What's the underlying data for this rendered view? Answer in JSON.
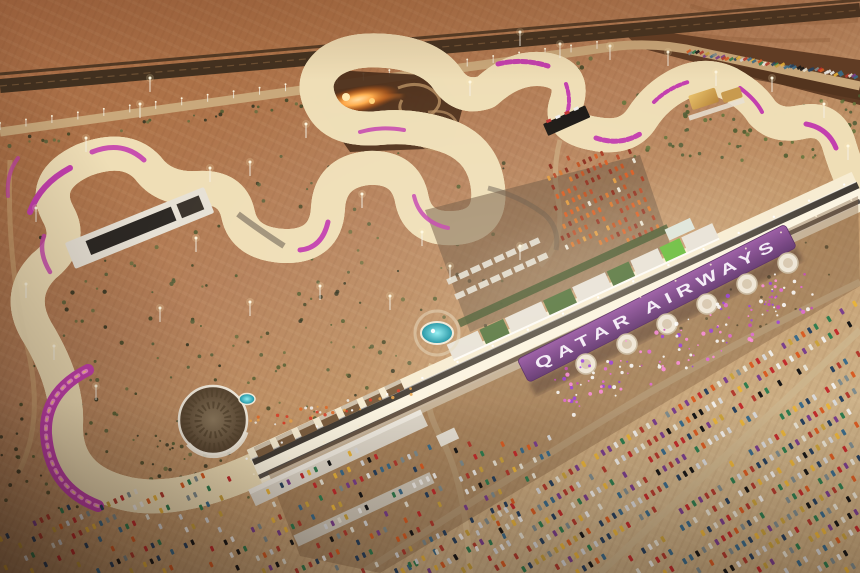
{
  "scene": {
    "type": "aerial-photo-render",
    "time_of_day": "dusk, floodlit",
    "subject": "desert grand prix circuit with illuminated winding track, pit complex, branded grandstand and full car parks",
    "visible_text": {
      "grandstand_roof": "QATAR AIRWAYS"
    },
    "palette": {
      "desert_top": "#a36843",
      "desert_mid": "#b5805a",
      "desert_light": "#d3b285",
      "runoff_sand": "#eeddb6",
      "lit_tarmac": "#f7ecd2",
      "track_asphalt": "#3a342e",
      "roof_purple": "#7b4488",
      "roof_text": "#f3ebf6",
      "kerb_magenta": "#c33fae",
      "kerb_pink": "#ff9bd9",
      "accent_gold": "#ffd27a",
      "pool_teal": "#2fc6cf",
      "pit_green": "#5e7c48",
      "bright_green": "#6fbf44",
      "fire_orange": "#ff8c2e",
      "shadow_brown": "#24140b"
    }
  },
  "parking": {
    "car_palette": [
      "#d8d8d8",
      "#f0ede8",
      "#b23b2e",
      "#d85c23",
      "#e8b33a",
      "#27415e",
      "#7f8c8d",
      "#2f7d4f",
      "#7a3f8c",
      "#171717",
      "#c22c2c",
      "#e8e2d2",
      "#caa23c",
      "#3a6b8a"
    ],
    "paddock_palette": [
      "#c05020",
      "#d8742c",
      "#a83a20",
      "#e09a40",
      "#8a2a1a",
      "#d85c23",
      "#b84a28",
      "#903020",
      "#e8e2d2"
    ]
  },
  "vegetation": {
    "colors": [
      "#3e4526",
      "#56603a",
      "#2f3320",
      "#6a6f3f",
      "#4e5c30"
    ]
  },
  "sparkles": {
    "colors": [
      "#e268d8",
      "#9b3fe0",
      "#ff8de0",
      "#ffffff",
      "#c44ab8"
    ]
  }
}
